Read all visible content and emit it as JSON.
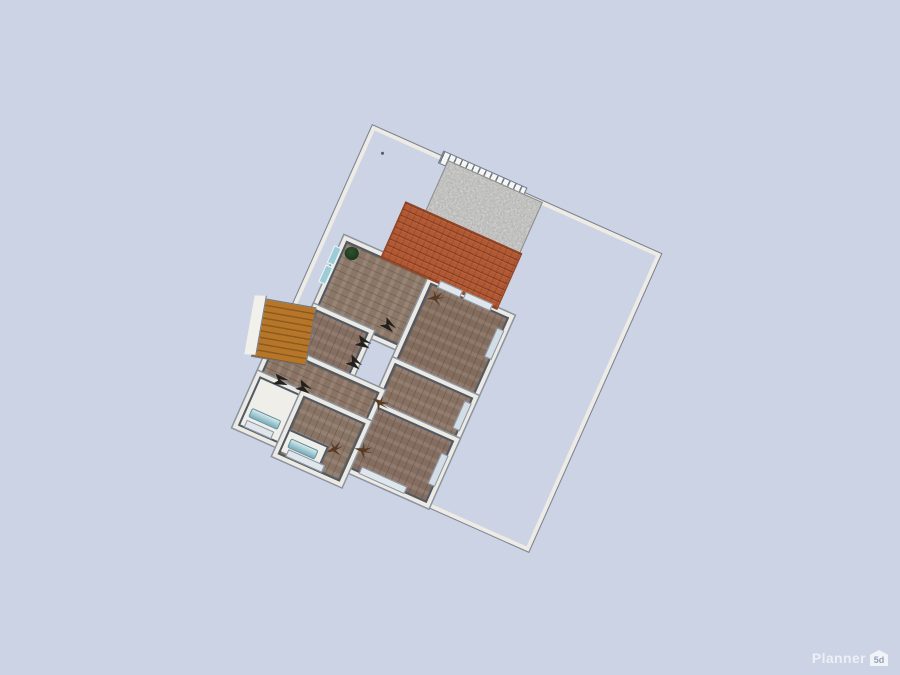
{
  "app": {
    "name": "Planner 5D"
  },
  "watermark": {
    "brand": "Planner",
    "badge": "5d"
  },
  "canvas": {
    "view": "2d-floor-plan-top-view",
    "background_color": "#cbd3e5",
    "plan_rotation_deg": 24
  },
  "palette": {
    "lot_line": "#79828f",
    "wall_line": "#4f5a66",
    "wall_fill": "#eceae3",
    "roof_terracotta": "#b25832",
    "gravel": "#a9a9a7",
    "wood_floor": "#8c7769",
    "stairs": "#b5762a",
    "bath_fixture": "#79aebc",
    "window_teal": "#9ccdd6"
  },
  "scene_elements": [
    "lot-boundary",
    "driveway-gate",
    "gravel-driveway",
    "terracotta-roof",
    "bedroom-top-left",
    "room-top-right",
    "small-room",
    "room-mid-right",
    "room-bottom-right",
    "hall",
    "living-area",
    "bathroom",
    "staircase",
    "potted-plant",
    "dry-plant",
    "door-swing-marker",
    "bath-fixture",
    "window"
  ]
}
